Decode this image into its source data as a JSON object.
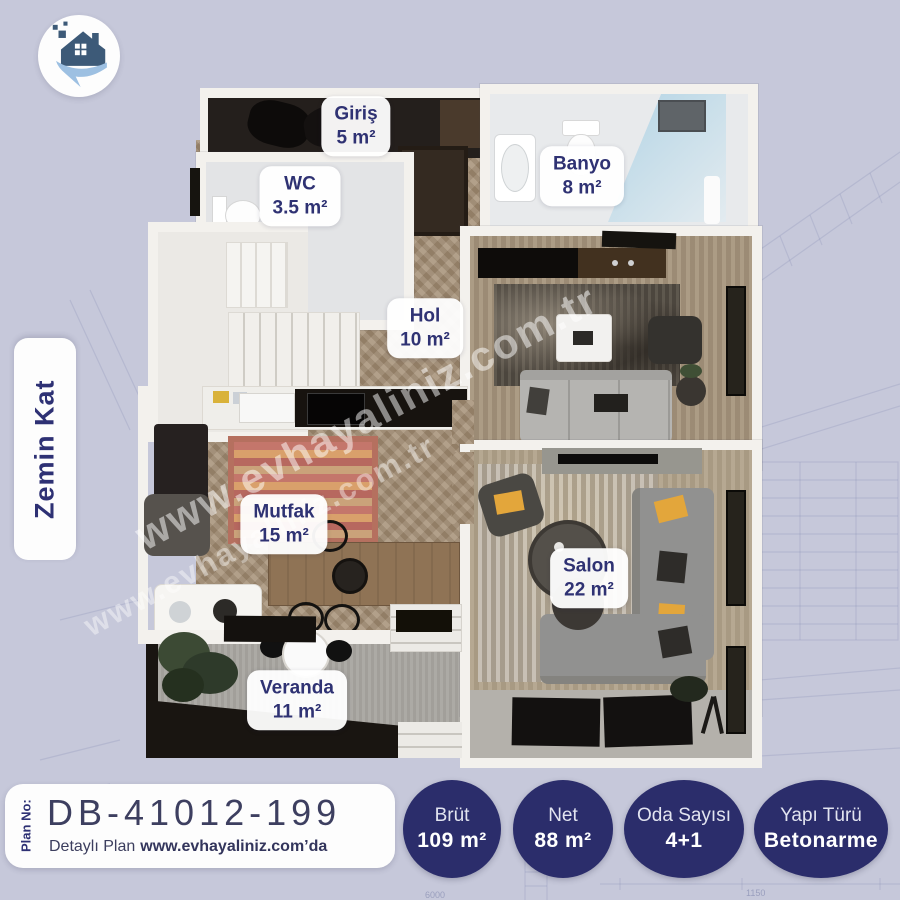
{
  "page": {
    "background_color": "#c6c8da"
  },
  "logo": {
    "icon": "evhayaliniz-house-logo"
  },
  "floor_tag": {
    "label": "Zemin Kat"
  },
  "watermark": {
    "text": "www.evhayaliniz.com.tr"
  },
  "rooms": [
    {
      "name": "Giriş",
      "area": "5 m²"
    },
    {
      "name": "WC",
      "area": "3.5 m²"
    },
    {
      "name": "Banyo",
      "area": "8 m²"
    },
    {
      "name": "Hol",
      "area": "10 m²"
    },
    {
      "name": "Mutfak",
      "area": "15 m²"
    },
    {
      "name": "Salon",
      "area": "22 m²"
    },
    {
      "name": "Veranda",
      "area": "11 m²"
    }
  ],
  "plan_card": {
    "plan_no_label": "Plan No:",
    "plan_no": "DB-41012-199",
    "detail_prefix": "Detaylı Plan",
    "detail_site": "www.evhayaliniz.com’da"
  },
  "badges": [
    {
      "label": "Brüt",
      "value": "109 m²"
    },
    {
      "label": "Net",
      "value": "88 m²"
    },
    {
      "label": "Oda Sayısı",
      "value": "4+1"
    },
    {
      "label": "Yapı Türü",
      "value": "Betonarme"
    }
  ],
  "background_sketch": {
    "dims": [
      "6000",
      "1150"
    ]
  },
  "colors": {
    "navy": "#2b2d6b",
    "label_text": "#2f3273",
    "background": "#c6c8da",
    "wood": "#a28e76",
    "accent_yellow": "#e3a63b"
  }
}
